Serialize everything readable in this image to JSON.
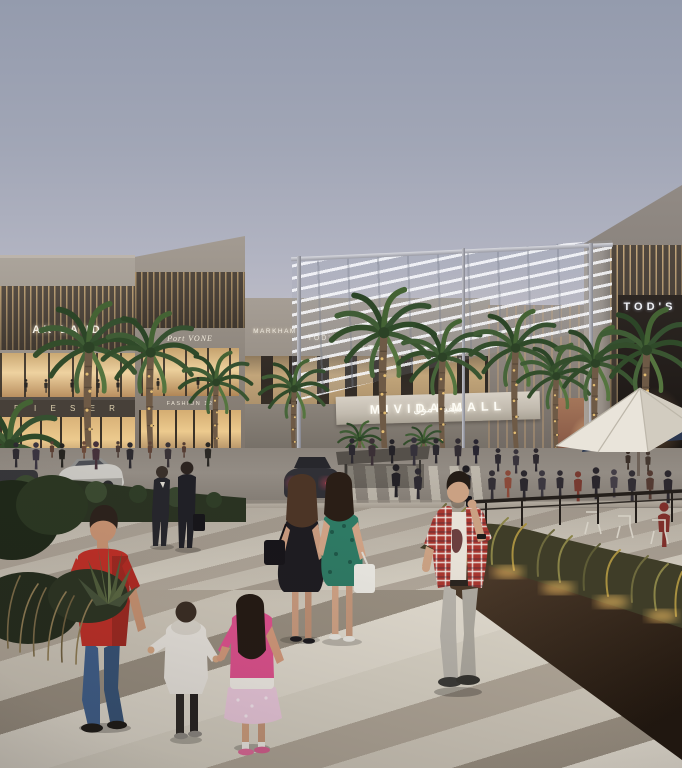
{
  "scene": {
    "description": "Dusk architectural rendering of an open-air shopping mall plaza with palm trees, a striped stone promenade, pedestrians, parked cars and an outdoor cafe terrace",
    "mall_name": "MIVIDA MALL",
    "mall_name_arabic": "ميفيدا مول"
  },
  "signs": {
    "left_upper": "AK LAND",
    "left_wing": "Port VONE",
    "left_lower": "D I E S E R",
    "left_boutique": "FASHION 12",
    "center_1": "MARKHAM",
    "center_2": "TOD'S",
    "center_3": "CITE",
    "center_4": "MIRA",
    "right_store": "TOD'S"
  },
  "figures": [
    "man-red-polo-holding-child-hand",
    "toddler-white-hoodie",
    "girl-pink-outfit",
    "woman-black-dress-back",
    "woman-green-print-dress-back",
    "man-on-phone-plaid-shirt",
    "two-businessmen-dark-suits",
    "cafe-terrace-crowd",
    "storefront-crowd"
  ],
  "colors": {
    "sky_top": "#949bad",
    "sky_horizon": "#d2cbcd",
    "stone_facade": "#9a9289",
    "warm_shop_glow": "#ecd09c",
    "pavement_light": "#d8d2c5",
    "pavement_dark": "#a89e91",
    "planter_wall": "#3a2b1d",
    "grass_uplight": "#f5c063",
    "awning_navy": "#2b374f",
    "palm_frond": "#3d5531",
    "red_polo": "#bf2f27",
    "taillight_red": "#ff5463"
  }
}
